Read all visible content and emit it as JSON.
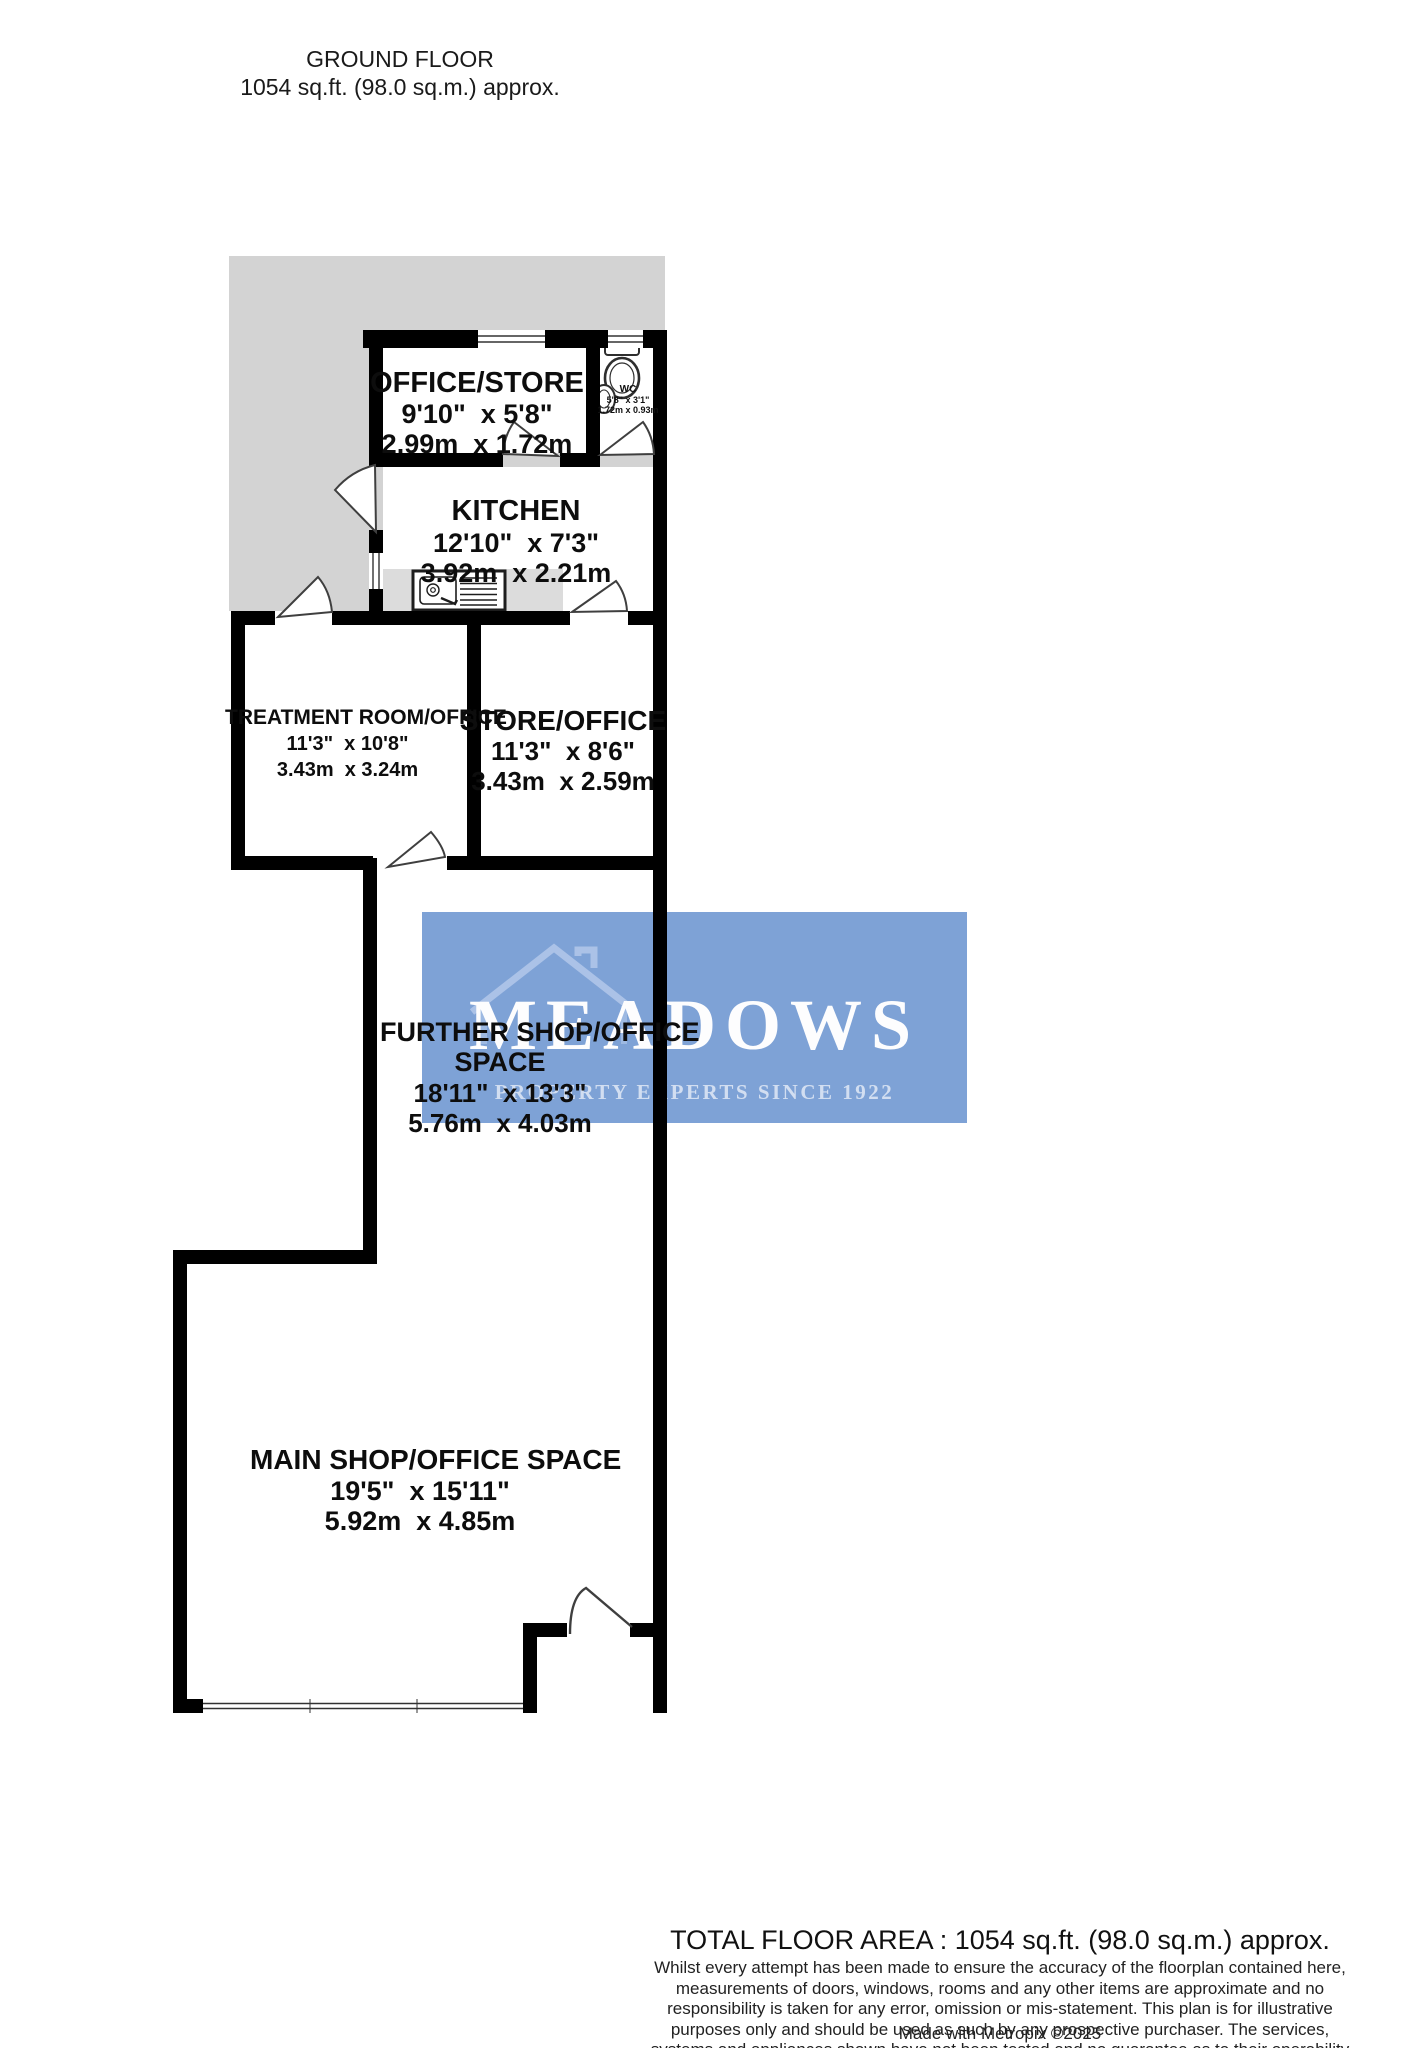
{
  "header": {
    "title": "GROUND FLOOR",
    "subtitle": "1054 sq.ft. (98.0 sq.m.) approx."
  },
  "rooms": {
    "office_store": {
      "name": "OFFICE/STORE",
      "dims_imperial": "9'10\"  x 5'8\"",
      "dims_metric": "2.99m  x 1.72m"
    },
    "wc": {
      "name": "WC",
      "dims_imperial": "5'8\" x 3'1\"",
      "dims_metric": "1.72m x 0.93m"
    },
    "kitchen": {
      "name": "KITCHEN",
      "dims_imperial": "12'10\"  x 7'3\"",
      "dims_metric": "3.92m  x 2.21m"
    },
    "treatment_room": {
      "name": "TREATMENT ROOM/OFFICE",
      "dims_imperial": "11'3\"  x 10'8\"",
      "dims_metric": "3.43m  x 3.24m"
    },
    "store_office": {
      "name": "STORE/OFFICE",
      "dims_imperial": "11'3\"  x 8'6\"",
      "dims_metric": "3.43m  x 2.59m"
    },
    "further_shop": {
      "name_line1": "FURTHER SHOP/OFFICE",
      "name_line2": "SPACE",
      "dims_imperial": "18'11\"  x 13'3\"",
      "dims_metric": "5.76m  x 4.03m"
    },
    "main_shop": {
      "name": "MAIN SHOP/OFFICE SPACE",
      "dims_imperial": "19'5\"  x 15'11\"",
      "dims_metric": "5.92m  x 4.85m"
    }
  },
  "watermark": {
    "name": "MEADOWS",
    "tagline": "PROPERTY EXPERTS SINCE 1922",
    "background": "#7ea2d6"
  },
  "footer": {
    "total": "TOTAL FLOOR AREA : 1054 sq.ft. (98.0 sq.m.) approx.",
    "disclaimer": "Whilst every attempt has been made to ensure the accuracy of the floorplan contained here, measurements of doors, windows, rooms and any other items are approximate and no responsibility is taken for any error, omission or mis-statement. This plan is for illustrative purposes only and should be used as such by any prospective purchaser. The services, systems and appliances shown have not been tested and no guarantee as to their operability or efficiency can be given.",
    "credit": "Made with Metropix ©2025"
  },
  "colors": {
    "wall": "#000000",
    "exterior_gray": "#d3d3d3",
    "counter_gray": "#dcdcdc",
    "door_stroke": "#3f3f3f",
    "watermark_blue": "#7ea2d6"
  }
}
